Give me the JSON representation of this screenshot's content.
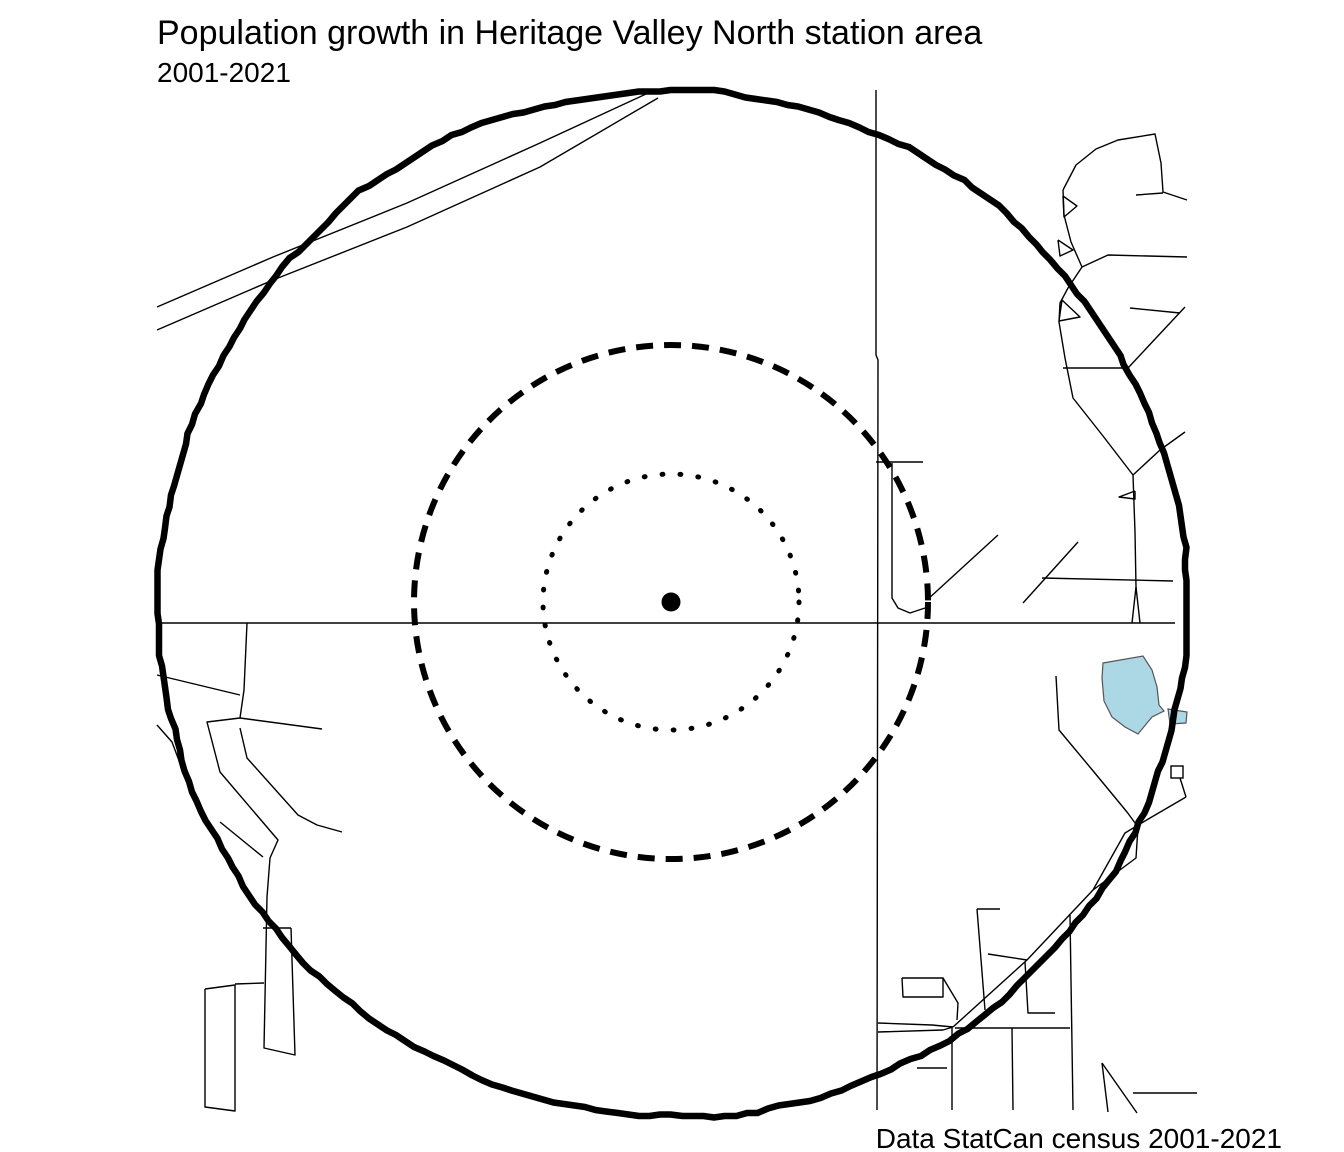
{
  "header": {
    "title": "Population growth in Heritage Valley North station area",
    "subtitle": "2001-2021"
  },
  "footer": {
    "caption": "Data StatCan census 2001-2021"
  },
  "colors": {
    "background": "#ffffff",
    "line": "#000000",
    "lake_fill": "#acd8e5",
    "lake_stroke": "#555555"
  },
  "map": {
    "width": 1344,
    "height": 1152,
    "center": {
      "x": 671,
      "y": 602
    },
    "station_dot": {
      "x": 671,
      "y": 602,
      "r": 9.5
    },
    "rings": [
      {
        "name": "inner-ring-dotted",
        "style": "dotted",
        "radius": 128,
        "stroke_width": 5,
        "dasharray": "0.8 17.2"
      },
      {
        "name": "middle-ring-dashed",
        "style": "dashed",
        "radius": 257,
        "stroke_width": 6,
        "dasharray": "17 11"
      },
      {
        "name": "outer-ring-solid",
        "style": "solid-jagged",
        "radius": 515,
        "stroke_width": 6.5,
        "wobble": 4.5
      }
    ],
    "lake": {
      "outline": [
        [
          1103,
          663
        ],
        [
          1143,
          656
        ],
        [
          1152,
          670
        ],
        [
          1157,
          687
        ],
        [
          1159,
          705
        ],
        [
          1164,
          711
        ],
        [
          1152,
          717
        ],
        [
          1138,
          734
        ],
        [
          1125,
          727
        ],
        [
          1112,
          717
        ],
        [
          1104,
          701
        ],
        [
          1102,
          678
        ]
      ],
      "lobe": [
        [
          1168,
          709
        ],
        [
          1187,
          712
        ],
        [
          1186,
          723
        ],
        [
          1170,
          724
        ]
      ]
    },
    "building": {
      "x": 1171,
      "y": 766,
      "w": 12,
      "h": 12
    },
    "roads": [
      {
        "name": "nw-diagonal-1",
        "points": [
          [
            157,
            307
          ],
          [
            273,
            257
          ],
          [
            407,
            203
          ],
          [
            540,
            143
          ],
          [
            646,
            94
          ]
        ]
      },
      {
        "name": "nw-diagonal-2",
        "points": [
          [
            157,
            330
          ],
          [
            273,
            280
          ],
          [
            407,
            227
          ],
          [
            540,
            167
          ],
          [
            658,
            98
          ]
        ]
      },
      {
        "name": "main-horizontal",
        "points": [
          [
            157,
            623
          ],
          [
            1175,
            623
          ]
        ]
      },
      {
        "name": "main-vertical",
        "points": [
          [
            876,
            90
          ],
          [
            876,
            355
          ],
          [
            878,
            360
          ],
          [
            877,
            1110
          ]
        ]
      },
      {
        "name": "t-branch-horizontal",
        "points": [
          [
            876,
            462
          ],
          [
            923,
            462
          ]
        ]
      },
      {
        "name": "branch-curve",
        "points": [
          [
            892,
            463
          ],
          [
            892,
            598
          ],
          [
            898,
            608
          ],
          [
            910,
            613
          ],
          [
            925,
            608
          ]
        ]
      },
      {
        "name": "mid-diagonal-a",
        "points": [
          [
            927,
            600
          ],
          [
            998,
            535
          ]
        ]
      },
      {
        "name": "mid-diagonal-b",
        "points": [
          [
            1023,
            603
          ],
          [
            1078,
            542
          ]
        ]
      },
      {
        "name": "east-horizontal",
        "points": [
          [
            1042,
            578
          ],
          [
            1173,
            581
          ]
        ]
      },
      {
        "name": "ne-road-long",
        "points": [
          [
            1063,
            190
          ],
          [
            1064,
            215
          ],
          [
            1071,
            242
          ],
          [
            1082,
            267
          ],
          [
            1068,
            288
          ],
          [
            1060,
            303
          ],
          [
            1059,
            322
          ],
          [
            1065,
            358
          ],
          [
            1073,
            398
          ],
          [
            1103,
            436
          ],
          [
            1133,
            475
          ],
          [
            1135,
            532
          ],
          [
            1136,
            587
          ],
          [
            1132,
            623
          ]
        ]
      },
      {
        "name": "ne-spike",
        "points": [
          [
            1136,
            587
          ],
          [
            1140,
            623
          ]
        ]
      },
      {
        "name": "ne-curve-top",
        "points": [
          [
            1063,
            190
          ],
          [
            1076,
            165
          ],
          [
            1096,
            149
          ],
          [
            1118,
            140
          ],
          [
            1155,
            134
          ],
          [
            1161,
            163
          ],
          [
            1163,
            192
          ],
          [
            1187,
            200
          ]
        ]
      },
      {
        "name": "ne-branch",
        "points": [
          [
            1136,
            195
          ],
          [
            1163,
            193
          ]
        ]
      },
      {
        "name": "ne-horizontal-1",
        "points": [
          [
            1082,
            267
          ],
          [
            1108,
            255
          ],
          [
            1187,
            257
          ]
        ]
      },
      {
        "name": "ne-horizontal-2",
        "points": [
          [
            1130,
            308
          ],
          [
            1180,
            313
          ]
        ]
      },
      {
        "name": "ne-diag-horizontal",
        "points": [
          [
            1185,
            307
          ],
          [
            1128,
            368
          ],
          [
            1063,
            368
          ]
        ]
      },
      {
        "name": "ne-diagonal-2",
        "points": [
          [
            1133,
            475
          ],
          [
            1160,
            450
          ],
          [
            1185,
            432
          ]
        ]
      },
      {
        "name": "loop-1",
        "points": [
          [
            1063,
            196
          ],
          [
            1077,
            206
          ],
          [
            1064,
            217
          ],
          [
            1063,
            196
          ]
        ]
      },
      {
        "name": "loop-2",
        "points": [
          [
            1058,
            240
          ],
          [
            1073,
            250
          ],
          [
            1060,
            256
          ],
          [
            1058,
            240
          ]
        ]
      },
      {
        "name": "loop-3",
        "points": [
          [
            1062,
            300
          ],
          [
            1080,
            317
          ],
          [
            1059,
            321
          ],
          [
            1062,
            300
          ]
        ]
      },
      {
        "name": "loop-4",
        "points": [
          [
            1135,
            491
          ],
          [
            1119,
            497
          ],
          [
            1135,
            499
          ],
          [
            1135,
            491
          ]
        ]
      },
      {
        "name": "lake-road",
        "points": [
          [
            1056,
            676
          ],
          [
            1059,
            730
          ],
          [
            1094,
            772
          ],
          [
            1127,
            812
          ],
          [
            1138,
            827
          ],
          [
            1136,
            858
          ],
          [
            1093,
            890
          ]
        ]
      },
      {
        "name": "se-parallel-road",
        "points": [
          [
            1186,
            797
          ],
          [
            1150,
            818
          ],
          [
            1125,
            833
          ],
          [
            1093,
            890
          ],
          [
            1027,
            960
          ],
          [
            953,
            1027
          ]
        ]
      },
      {
        "name": "building-lane",
        "points": [
          [
            1180,
            778
          ],
          [
            1186,
            797
          ]
        ]
      },
      {
        "name": "se-horizontal-1",
        "points": [
          [
            878,
            1023
          ],
          [
            932,
            1025
          ],
          [
            953,
            1027
          ]
        ]
      },
      {
        "name": "se-horizontal-2",
        "points": [
          [
            878,
            1032
          ],
          [
            943,
            1030
          ],
          [
            953,
            1027
          ]
        ]
      },
      {
        "name": "se-block",
        "points": [
          [
            902,
            978
          ],
          [
            943,
            978
          ],
          [
            943,
            997
          ],
          [
            903,
            997
          ],
          [
            902,
            978
          ]
        ]
      },
      {
        "name": "se-block-diagonal",
        "points": [
          [
            943,
            978
          ],
          [
            958,
            1003
          ],
          [
            957,
            1020
          ]
        ]
      },
      {
        "name": "se-vertical-1-top",
        "points": [
          [
            977,
            909
          ],
          [
            1000,
            909
          ]
        ]
      },
      {
        "name": "se-vertical-1",
        "points": [
          [
            977,
            909
          ],
          [
            985,
            1010
          ]
        ]
      },
      {
        "name": "se-diagonal-c",
        "points": [
          [
            988,
            954
          ],
          [
            1027,
            960
          ]
        ]
      },
      {
        "name": "se-vertical-2",
        "points": [
          [
            1025,
            962
          ],
          [
            1028,
            1013
          ],
          [
            1055,
            1013
          ]
        ]
      },
      {
        "name": "se-long-horizontal",
        "points": [
          [
            955,
            1028
          ],
          [
            1070,
            1028
          ]
        ]
      },
      {
        "name": "se-vertical-3",
        "points": [
          [
            1012,
            1028
          ],
          [
            1013,
            1110
          ]
        ]
      },
      {
        "name": "se-vertical-4",
        "points": [
          [
            1070,
            915
          ],
          [
            1073,
            1110
          ]
        ]
      },
      {
        "name": "se-vertical-5",
        "points": [
          [
            952,
            1028
          ],
          [
            952,
            1110
          ]
        ]
      },
      {
        "name": "se-horizontal-3",
        "points": [
          [
            917,
            1068
          ],
          [
            947,
            1068
          ]
        ]
      },
      {
        "name": "se-corner-diag-1",
        "points": [
          [
            1102,
            1063
          ],
          [
            1137,
            1113
          ]
        ]
      },
      {
        "name": "se-corner-diag-2",
        "points": [
          [
            1102,
            1063
          ],
          [
            1108,
            1112
          ]
        ]
      },
      {
        "name": "se-corner-horizontal",
        "points": [
          [
            1133,
            1093
          ],
          [
            1197,
            1093
          ]
        ]
      },
      {
        "name": "w-vertical",
        "points": [
          [
            247,
            623
          ],
          [
            244,
            690
          ],
          [
            240,
            718
          ]
        ]
      },
      {
        "name": "w-diag-in",
        "points": [
          [
            157,
            675
          ],
          [
            240,
            695
          ]
        ]
      },
      {
        "name": "w-horizontal",
        "points": [
          [
            240,
            718
          ],
          [
            322,
            729
          ]
        ]
      },
      {
        "name": "w-long-road",
        "points": [
          [
            240,
            718
          ],
          [
            207,
            722
          ],
          [
            220,
            772
          ],
          [
            278,
            840
          ],
          [
            270,
            858
          ],
          [
            267,
            897
          ],
          [
            264,
            1048
          ],
          [
            295,
            1055
          ],
          [
            291,
            928
          ]
        ]
      },
      {
        "name": "w-rect2-top",
        "points": [
          [
            263,
            928
          ],
          [
            291,
            928
          ]
        ]
      },
      {
        "name": "w-rect1-link",
        "points": [
          [
            235,
            984
          ],
          [
            264,
            983
          ]
        ]
      },
      {
        "name": "w-diagonal-2",
        "points": [
          [
            240,
            728
          ],
          [
            247,
            758
          ],
          [
            298,
            815
          ],
          [
            317,
            825
          ],
          [
            342,
            832
          ]
        ]
      },
      {
        "name": "w-diagonal-3",
        "points": [
          [
            220,
            822
          ],
          [
            263,
            857
          ]
        ]
      },
      {
        "name": "w-edge-diagonal",
        "points": [
          [
            157,
            725
          ],
          [
            172,
            742
          ],
          [
            190,
            790
          ]
        ]
      },
      {
        "name": "w-rect1",
        "points": [
          [
            205,
            989
          ],
          [
            235,
            985
          ],
          [
            235,
            1111
          ],
          [
            205,
            1107
          ],
          [
            205,
            989
          ]
        ]
      }
    ]
  }
}
